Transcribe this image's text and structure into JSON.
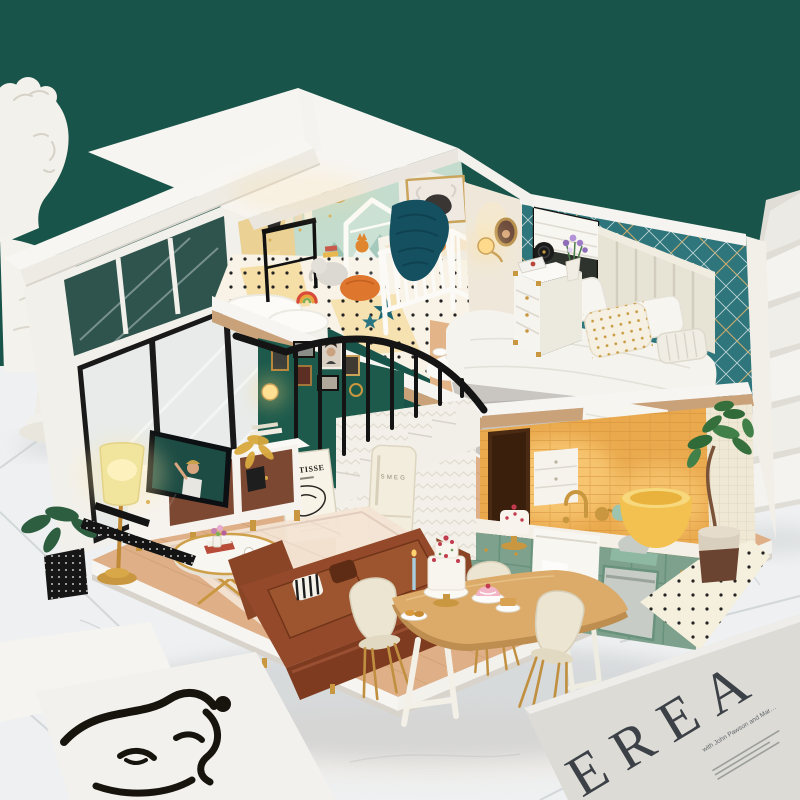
{
  "scene": {
    "subject": "DIY miniature dollhouse loft diorama",
    "setting": {
      "backdrop": "dark teal wall",
      "floor": "white marble tiles",
      "left_prop": "white classical bust statue",
      "right_prop": "white marble staircase steps"
    }
  },
  "colors": {
    "wall_teal": "#19544a",
    "marble": "#eef0f1",
    "house_white": "#f5f2ee",
    "wood_floor": "#dfb087",
    "nursery_mint": "#c3dccd",
    "bedroom_teal": "#2e767c",
    "sofa_brown": "#93492a",
    "kitchen_glow": "#eaa94d",
    "cabinet_sage": "#7da18c",
    "tub_yellow": "#f2c14f",
    "accent_gold": "#c9973f",
    "railing_black": "#141414",
    "magazine_gray": "#dcdbd6"
  },
  "dollhouse": {
    "nursery": {
      "items": [
        "white crib",
        "highland cow art print",
        "mountain mural",
        "wall clock",
        "black plant stand with books",
        "house-frame wardrobe",
        "rainbow toy",
        "elephant plush",
        "orange pouf",
        "teal star pillows",
        "chunky knit blanket",
        "fluffy white rug",
        "polka-dot floor"
      ]
    },
    "bedroom": {
      "items": [
        "channel-tufted headboard",
        "double bed with white duvet",
        "gray blanket",
        "gold-dot pillow",
        "ribbed lumbar pillow",
        "fringed throw over loft edge",
        "white dresser nightstand with gold corners",
        "round black radio",
        "purple flowers in vase",
        "roman-blind window",
        "glowing wall sconce",
        "oval portrait",
        "breakfast rug with croissants",
        "slippers"
      ]
    },
    "living_room": {
      "poster_title": "MATISSE",
      "items": [
        "black framed glass wall",
        "gold floor lamp with glowing shade",
        "television",
        "white and walnut tv console",
        "round gold coffee table",
        "brown leather sofa",
        "striped pillow",
        "cream area rug",
        "green gallery wall with gold frames",
        "black stair railing",
        "white staircase",
        "monstera plant",
        "golden-leaf plant",
        "black perforated kit parts"
      ]
    },
    "kitchen": {
      "fridge_brand": "SMEG",
      "items": [
        "sage green cabinets",
        "marble counter",
        "farmhouse sink with towel",
        "gold faucet",
        "mint stand mixer",
        "gold kettle",
        "cake on stand",
        "steel dishwasher",
        "dark doorway with checker mat",
        "warm brick wall glow",
        "white cabinet"
      ]
    },
    "dining": {
      "items": [
        "wooden dining table with white legs",
        "three cream shell chairs with gold legs",
        "tiered berry cake",
        "pink cake",
        "croissant plate",
        "pancake plate",
        "blue candle"
      ]
    },
    "bathroom": {
      "items": [
        "yellow bathtub",
        "fiddle-leaf fig tree",
        "two-tone planter",
        "polka-dot floor",
        "beige tile wall"
      ]
    }
  },
  "foreground": {
    "magazine": {
      "visible_letters": "EREA",
      "caption_fragment": "with John Pawson and Mar…"
    },
    "art_print": {
      "subject": "abstract one-line face drawing"
    }
  }
}
